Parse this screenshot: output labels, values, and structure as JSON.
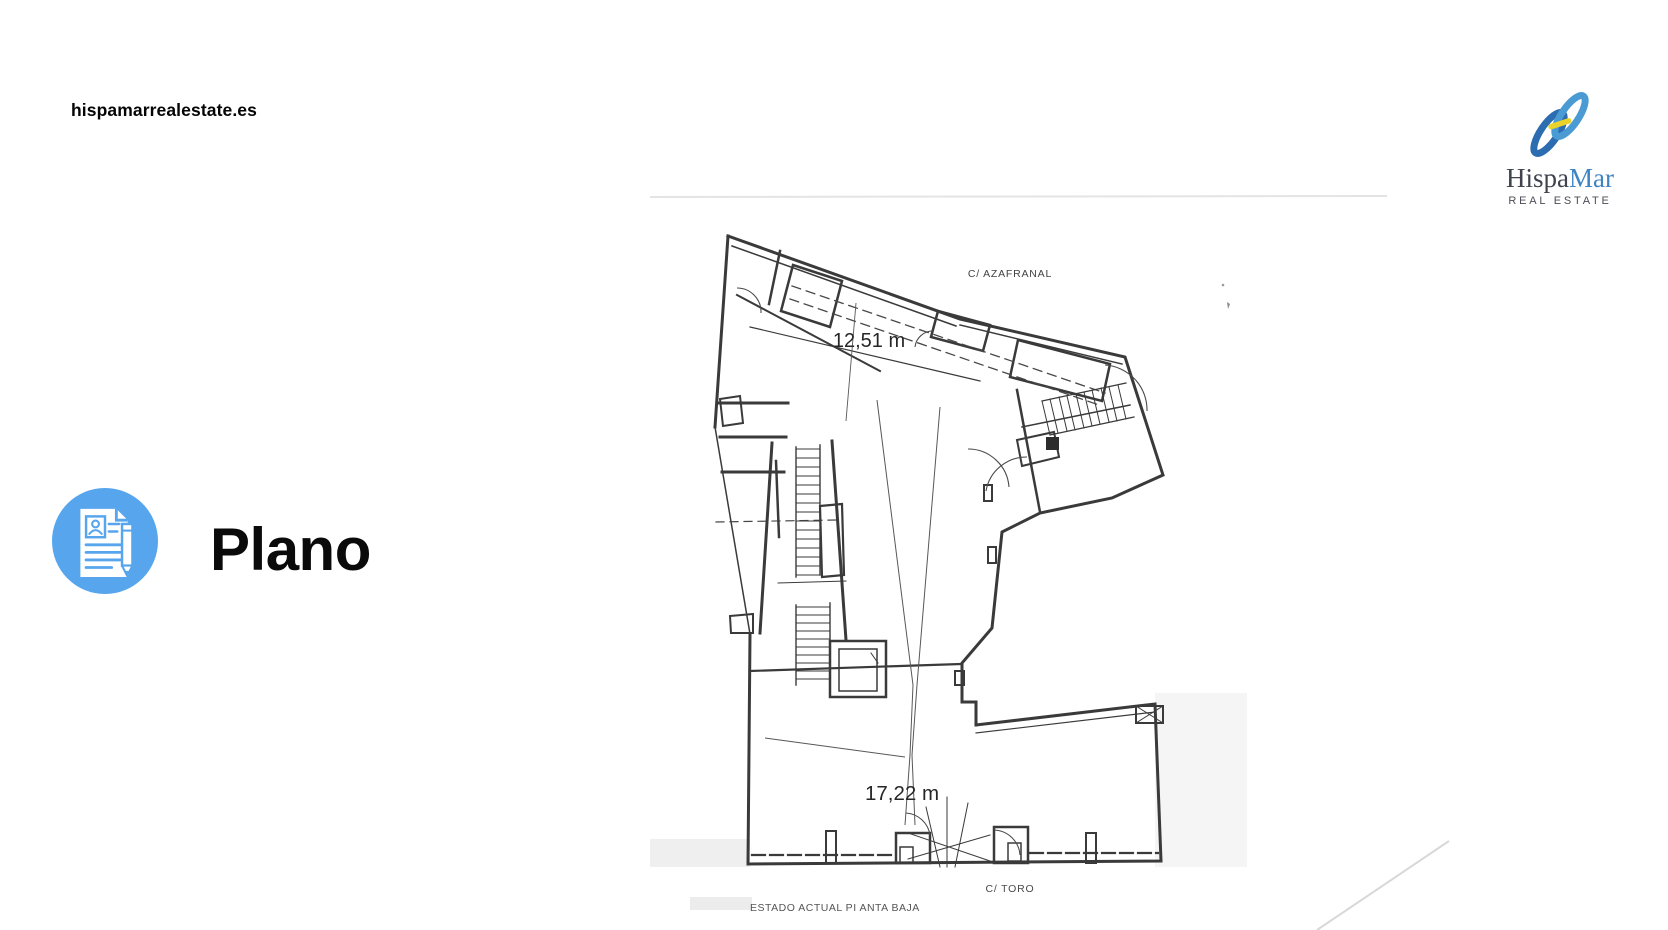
{
  "page": {
    "background_color": "#ffffff"
  },
  "header": {
    "website": "hispamarrealestate.es"
  },
  "logo": {
    "name_primary": "Hispa",
    "name_secondary": "Mar",
    "tagline": "REAL ESTATE",
    "mark_blue_dark": "#2c6cb0",
    "mark_blue_light": "#4a9ad4",
    "mark_yellow": "#ecd32b"
  },
  "section": {
    "title": "Plano",
    "icon_color": "#57a6ed"
  },
  "floor_plan": {
    "street_top_label": "C/ AZAFRANAL",
    "dimension_top": "12,51 m",
    "dimension_bottom": "17,22 m",
    "street_bottom_label": "C/ TORO",
    "caption": "ESTADO ACTUAL PI ANTA BAJA"
  }
}
